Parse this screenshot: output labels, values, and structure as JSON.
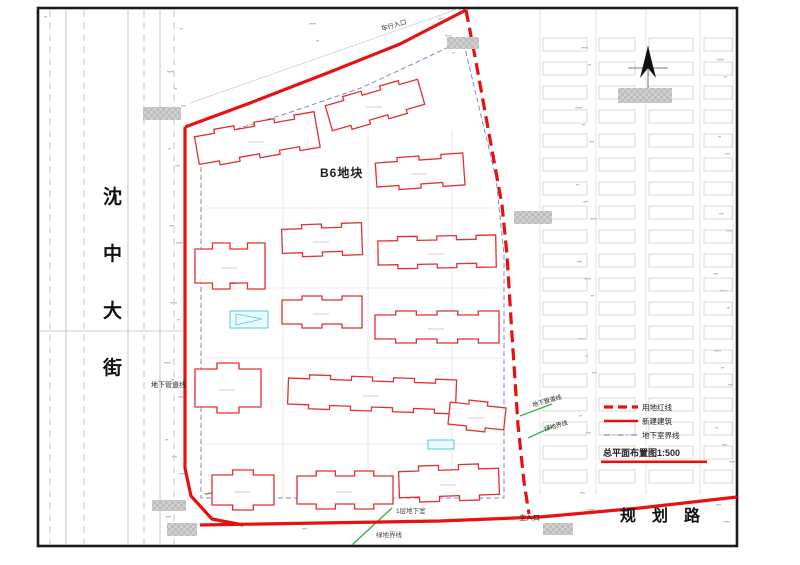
{
  "colors": {
    "red": "#e81010",
    "building_red": "#e03030",
    "blue_dash": "#8585cf",
    "green": "#3db24b",
    "cyan": "#57c8d8",
    "fabric": "#c8c8c8",
    "ink": "#1c1c1c"
  },
  "streets": {
    "left": "沈中大街",
    "bottom": "规划路"
  },
  "legend": {
    "items": [
      {
        "label": "用地红线",
        "style": "dashed-red"
      },
      {
        "label": "新建建筑",
        "style": "solid-red"
      },
      {
        "label": "地下室界线",
        "style": "dash-blue"
      }
    ],
    "title": "总平面布置图1:500"
  },
  "labels": [
    {
      "id": "vehicle-entrance-label",
      "text": "车行入口",
      "x": 382,
      "y": 31,
      "size": 6.5,
      "color": "#333333",
      "rotate": -16
    },
    {
      "id": "main-entrance-label",
      "text": "主入口",
      "x": 519,
      "y": 520,
      "size": 7,
      "color": "#222222",
      "rotate": 0
    },
    {
      "id": "basement-level-label",
      "text": "1层地下室",
      "x": 396,
      "y": 513,
      "size": 6.5,
      "color": "#444444",
      "rotate": 0
    },
    {
      "id": "green-boundary-label-bottom",
      "text": "绿地界线",
      "x": 376,
      "y": 537,
      "size": 6.5,
      "color": "#444444",
      "rotate": 0
    },
    {
      "id": "pipeline-label-left",
      "text": "地下管道线",
      "x": 151,
      "y": 387,
      "size": 7,
      "color": "#222222",
      "rotate": 0
    },
    {
      "id": "pipeline-label-right",
      "text": "地下管道线",
      "x": 533,
      "y": 407,
      "size": 6,
      "color": "#222222",
      "rotate": -16
    },
    {
      "id": "green-boundary-label-right",
      "text": "绿地界线",
      "x": 545,
      "y": 431,
      "size": 6,
      "color": "#222222",
      "rotate": -16
    }
  ],
  "site": {
    "plot_label": "B6地块",
    "red_solid_polylines": [
      "185,127 250,103 330,72 400,44 466,10",
      "185,127 185,468 191,496 212,519 243,525",
      "200,525 320,523 440,521 540,517 640,508 737,497"
    ],
    "red_dashed_polyline": "466,10 476,62 492,150 502,205 507,255 512,335 518,425 524,482 529,514",
    "basement_outline": "201,143 201,498 504,498 504,255 496,178 463,40 430,56 361,88 288,113 240,128 201,143",
    "buildings": [
      {
        "cx": 257,
        "cy": 140,
        "w": 122,
        "h": 28,
        "a": -10,
        "d": 4
      },
      {
        "cx": 375,
        "cy": 105,
        "w": 96,
        "h": 26,
        "a": -16,
        "d": 4
      },
      {
        "cx": 420,
        "cy": 172,
        "w": 88,
        "h": 24,
        "a": -4,
        "d": 4
      },
      {
        "cx": 230,
        "cy": 266,
        "w": 70,
        "h": 34,
        "a": 0,
        "d": 6
      },
      {
        "cx": 322,
        "cy": 240,
        "w": 80,
        "h": 24,
        "a": -2,
        "d": 4
      },
      {
        "cx": 437,
        "cy": 252,
        "w": 118,
        "h": 24,
        "a": -1,
        "d": 4
      },
      {
        "cx": 322,
        "cy": 312,
        "w": 80,
        "h": 24,
        "a": 0,
        "d": 4
      },
      {
        "cx": 437,
        "cy": 327,
        "w": 124,
        "h": 24,
        "a": 0,
        "d": 4
      },
      {
        "cx": 228,
        "cy": 388,
        "w": 66,
        "h": 38,
        "a": 0,
        "d": 6
      },
      {
        "cx": 372,
        "cy": 394,
        "w": 168,
        "h": 26,
        "a": 2,
        "d": 4
      },
      {
        "cx": 477,
        "cy": 416,
        "w": 56,
        "h": 22,
        "a": 6,
        "d": 4
      },
      {
        "cx": 243,
        "cy": 490,
        "w": 62,
        "h": 30,
        "a": 0,
        "d": 5
      },
      {
        "cx": 345,
        "cy": 490,
        "w": 96,
        "h": 28,
        "a": 0,
        "d": 5
      },
      {
        "cx": 449,
        "cy": 483,
        "w": 100,
        "h": 26,
        "a": -2,
        "d": 5
      }
    ],
    "green_segments": [
      "352,545 392,508",
      "520,416 552,404",
      "528,438 552,427",
      "205,494 228,491",
      "222,284 238,283"
    ],
    "cyan_boxes": [
      {
        "x": 230,
        "y": 311,
        "w": 38,
        "h": 17,
        "tri": "236,314 262,319 236,325"
      },
      {
        "x": 428,
        "y": 440,
        "w": 26,
        "h": 9,
        "tri": ""
      }
    ],
    "censor_boxes": [
      {
        "x": 143,
        "y": 107,
        "w": 38,
        "h": 13
      },
      {
        "x": 447,
        "y": 37,
        "w": 32,
        "h": 12
      },
      {
        "x": 514,
        "y": 211,
        "w": 38,
        "h": 13
      },
      {
        "x": 618,
        "y": 88,
        "w": 54,
        "h": 15
      },
      {
        "x": 543,
        "y": 523,
        "w": 30,
        "h": 12
      },
      {
        "x": 152,
        "y": 500,
        "w": 34,
        "h": 11
      },
      {
        "x": 167,
        "y": 523,
        "w": 30,
        "h": 13
      }
    ]
  },
  "background": {
    "left_road_lines": [
      {
        "x": 50,
        "dash": true
      },
      {
        "x": 66,
        "dash": false
      },
      {
        "x": 84,
        "dash": true
      },
      {
        "x": 128,
        "dash": false
      },
      {
        "x": 144,
        "dash": true
      },
      {
        "x": 160,
        "dash": false
      },
      {
        "x": 174,
        "dash": true
      }
    ],
    "right_blocks": [
      {
        "x": 543,
        "y": 38,
        "w": 44,
        "h": 13,
        "rows": 19,
        "gap": 24
      },
      {
        "x": 599,
        "y": 38,
        "w": 36,
        "h": 13,
        "rows": 19,
        "gap": 24
      },
      {
        "x": 649,
        "y": 38,
        "w": 44,
        "h": 13,
        "rows": 19,
        "gap": 24
      },
      {
        "x": 704,
        "y": 38,
        "w": 28,
        "h": 13,
        "rows": 19,
        "gap": 24
      }
    ],
    "right_street_lines": [
      540,
      596,
      646,
      700,
      733
    ],
    "inner_v": [
      283,
      368,
      452
    ],
    "inner_h": [
      208,
      288,
      358,
      444
    ],
    "noise_count": 90
  }
}
